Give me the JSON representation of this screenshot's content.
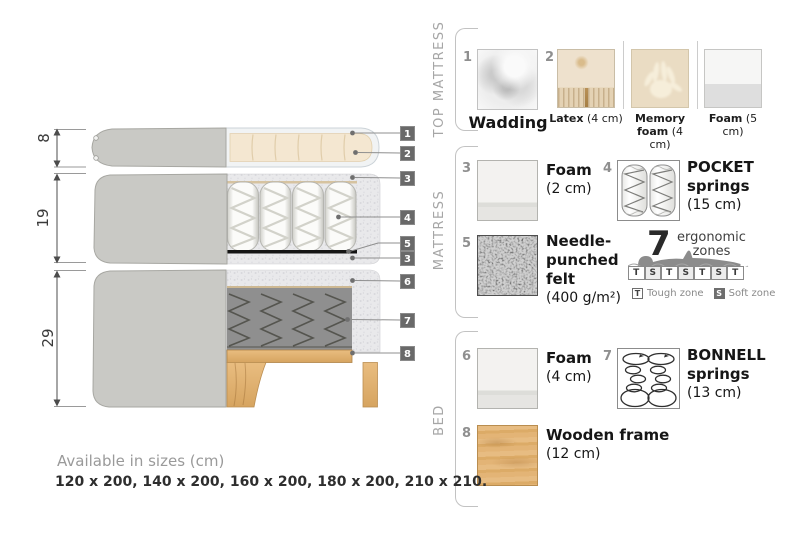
{
  "colors": {
    "cover_gray": "#c9c9c5",
    "cream_foam": "#f4e7d1",
    "wood": "#ddab67",
    "callout_bg": "#696969",
    "muted_text": "#9a9a9a",
    "dark_text": "#2e2e2e"
  },
  "diagram": {
    "heights": [
      "8",
      "19",
      "29"
    ],
    "callouts": [
      "1",
      "2",
      "3",
      "4",
      "5",
      "3",
      "6",
      "7",
      "8"
    ]
  },
  "panel": {
    "top_mattress": {
      "title": "TOP MATTRESS",
      "wadding": {
        "num": "1",
        "name": "Wadding"
      },
      "options": {
        "num": "2",
        "items": [
          {
            "name": "Latex",
            "size": "(4 cm)"
          },
          {
            "name": "Memory foam",
            "size": "(4 cm)"
          },
          {
            "name": "Foam",
            "size": "(5 cm)"
          }
        ]
      }
    },
    "mattress": {
      "title": "MATTRESS",
      "foam": {
        "num": "3",
        "lines": [
          "Foam"
        ],
        "size": "(2 cm)"
      },
      "pocket_springs": {
        "num": "4",
        "lines": [
          "POCKET",
          "springs"
        ],
        "size": "(15 cm)"
      },
      "felt": {
        "num": "5",
        "lines": [
          "Needle-",
          "punched",
          "felt"
        ],
        "size": "(400 g/m²)"
      },
      "zones": {
        "count": "7",
        "caption_lines": [
          "ergonomic",
          "zones"
        ],
        "pattern": [
          "T",
          "S",
          "T",
          "S",
          "T",
          "S",
          "T"
        ],
        "legend": [
          {
            "key": "T",
            "label": "Tough zone"
          },
          {
            "key": "S",
            "label": "Soft zone"
          }
        ]
      }
    },
    "bed": {
      "title": "BED",
      "foam": {
        "num": "6",
        "lines": [
          "Foam"
        ],
        "size": "(4 cm)"
      },
      "bonnell_springs": {
        "num": "7",
        "lines": [
          "BONNELL",
          "springs"
        ],
        "size": "(13 cm)"
      },
      "wooden_frame": {
        "num": "8",
        "lines": [
          "Wooden frame"
        ],
        "size": "(12 cm)"
      }
    }
  },
  "footer": {
    "title": "Available in sizes (cm)",
    "sizes": "120 x 200, 140 x 200, 160 x 200, 180 x 200, 210 x 210."
  }
}
